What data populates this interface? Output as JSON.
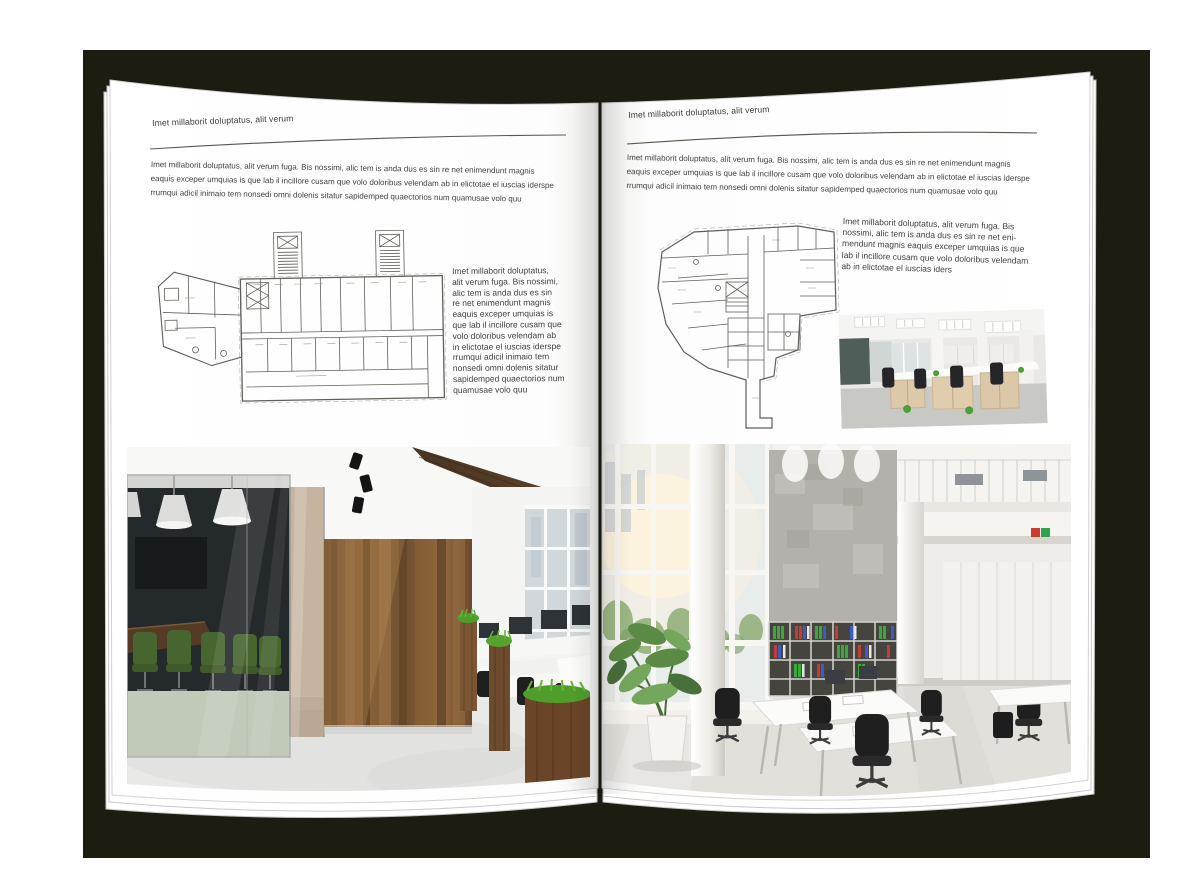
{
  "book": {
    "backdrop_color": "#1d1c10",
    "page_color": "#ffffff"
  },
  "left_page": {
    "header": "Imet millaborit doluptatus, alit verum",
    "intro_lines": [
      "Imet millaborit doluptatus, alit verum fuga. Bis nossimi, alic tem is anda dus es sin re net enimendunt magnis",
      "eaquis exceper umquias is que lab il incillore cusam que volo doloribus velendam ab in elictotae el iuscias iderspe",
      "rrumqui adicil inimaio tem nonsedi omni dolenis sitatur sapidemped quaectorios num quamusae volo quu"
    ],
    "side_lines": [
      "Imet millaborit doluptatus,",
      "alit verum fuga. Bis nossimi,",
      "alic tem is anda dus es sin",
      "re net enimendunt magnis",
      "eaquis exceper umquias is",
      "que lab il incillore cusam que",
      "volo doloribus velendam ab",
      "in elictotae el iuscias iderspe",
      "rrumqui adicil inimaio tem",
      "nonsedi omni dolenis sitatur",
      "sapidemped quaectorios num",
      "quamusae volo quu"
    ],
    "floor_plan_alt": "building-floor-plan-drawing",
    "photo_alt": "loft-office-interior-photo"
  },
  "right_page": {
    "header": "Imet millaborit doluptatus, alit verum",
    "intro_lines": [
      "Imet millaborit doluptatus, alit verum fuga. Bis nossimi, alic tem is anda dus es sin re net enimendunt magnis",
      "eaquis exceper umquias is que lab il incillore cusam que volo doloribus velendam ab in elictotae el iuscias iderspe",
      "rrumqui adicil inimaio tem nonsedi omni dolenis sitatur sapidemped quaectorios num quamusae volo quu"
    ],
    "side_lines": [
      "Imet millaborit doluptatus, alit verum fuga. Bis",
      "nossimi, alic tem is anda dus es sin re net eni-",
      "mendunt magnis eaquis exceper umquias is que",
      "lab il incillore cusam que volo doloribus velendam",
      "ab in elictotae el iuscias iders"
    ],
    "floor_plan_alt": "building-floor-plan-drawing",
    "photo_small_alt": "office-workstations-photo",
    "photo_alt": "open-space-office-photo"
  },
  "colors": {
    "plan_line": "#5f5f5a",
    "wood_wall": "#7b5634",
    "chair_green": "#47652f",
    "binder_green": "#3aa83a",
    "binder_red": "#c63c32",
    "binder_blue": "#3c5cc5"
  }
}
